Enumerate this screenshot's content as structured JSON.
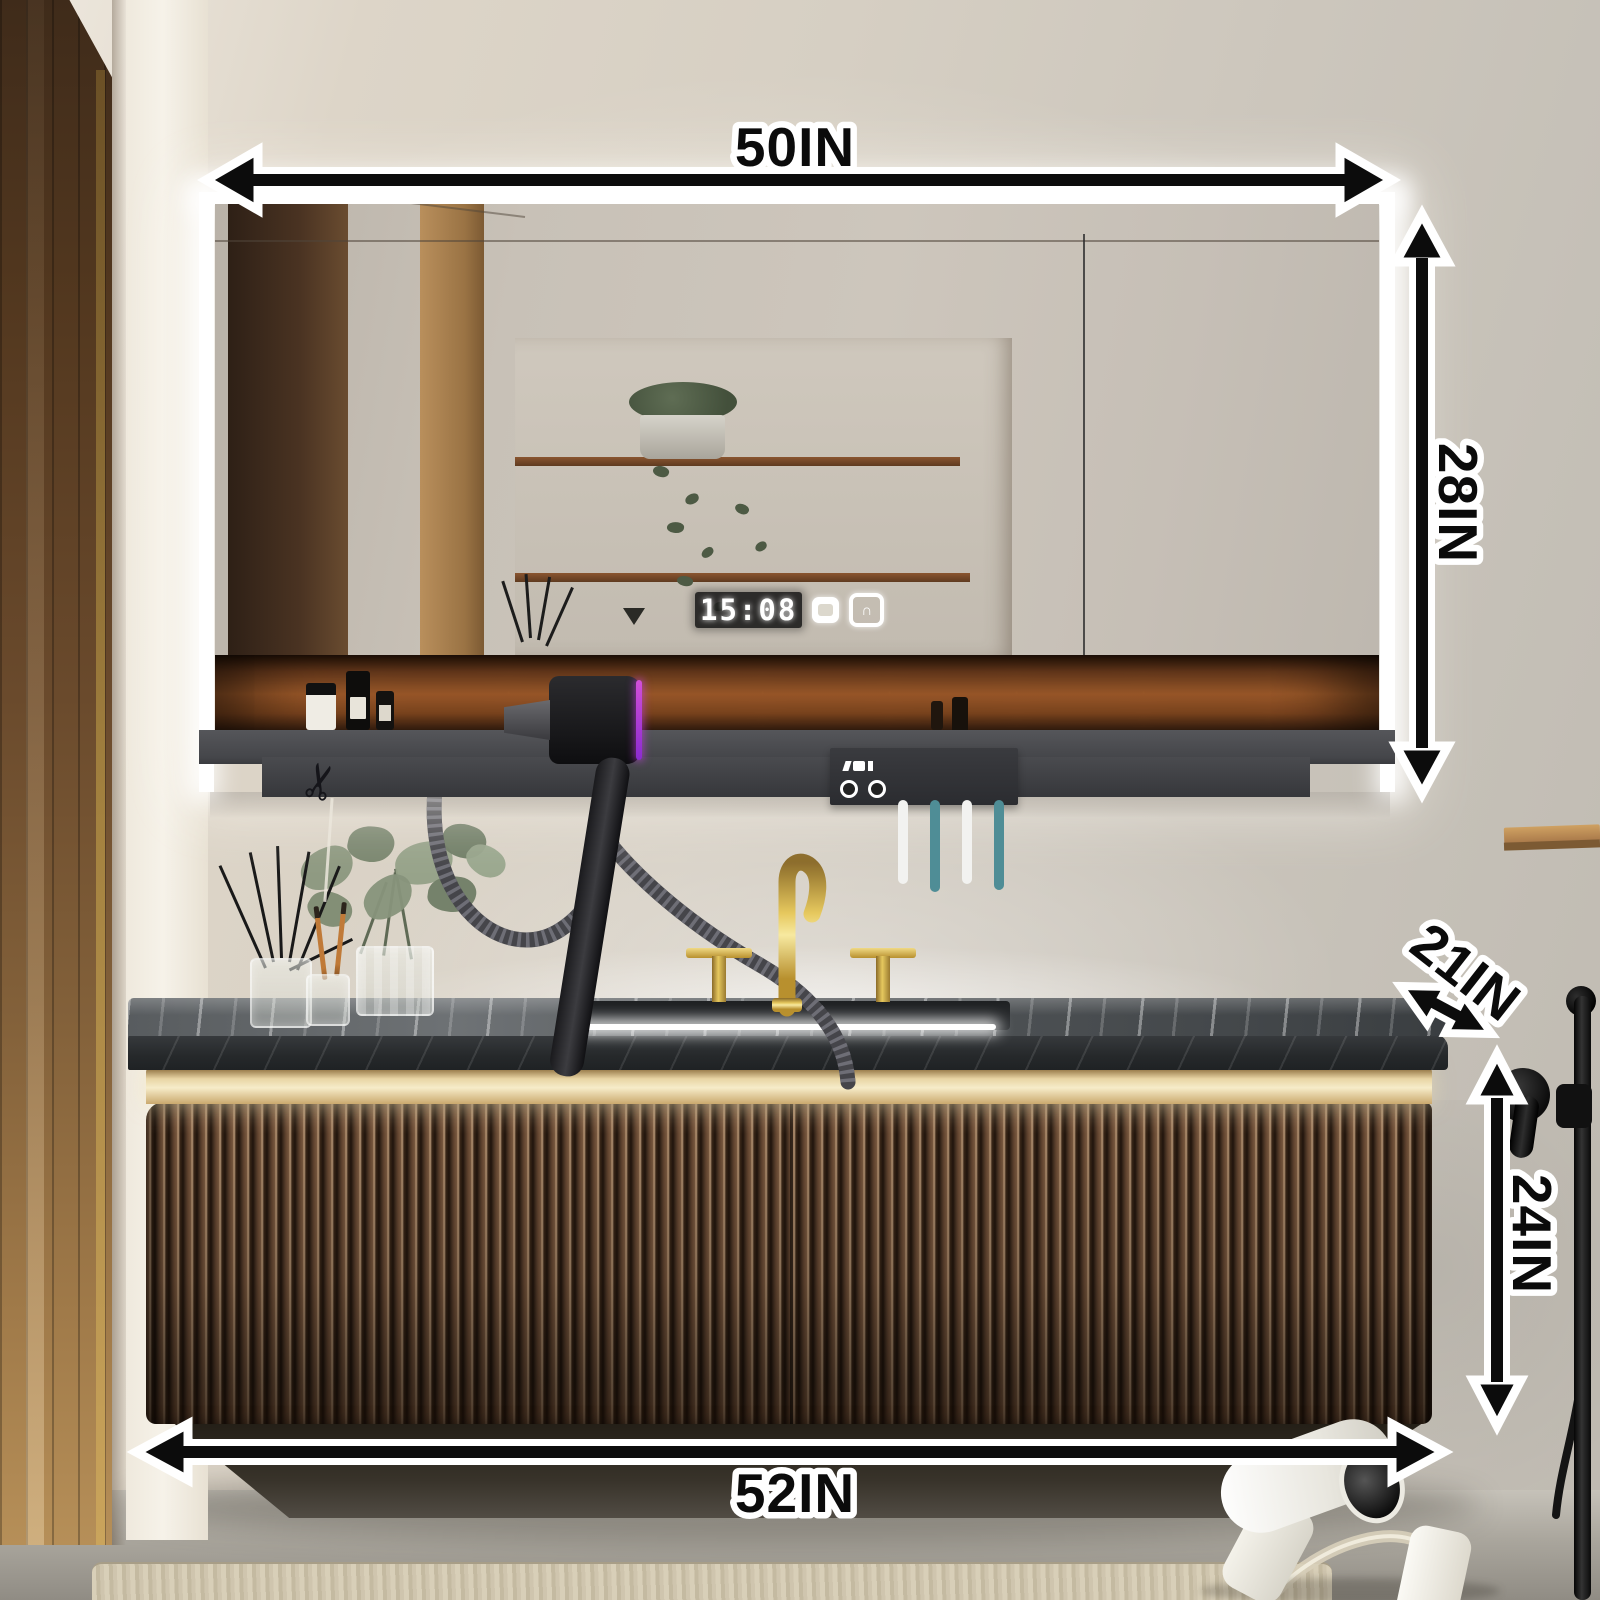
{
  "annotations": {
    "mirror_width": "50IN",
    "mirror_height": "28IN",
    "countertop_depth": "21IN",
    "vanity_height": "24IN",
    "vanity_width": "52IN"
  },
  "mirror_display": {
    "time": "15:08",
    "icons": [
      {
        "name": "defogger-icon"
      },
      {
        "name": "power-icon",
        "glyph": "∩"
      }
    ]
  },
  "icons": {
    "scissors_glyph": "✂"
  },
  "colors": {
    "annotation_fill": "#0b0b0b",
    "annotation_outline": "#ffffff",
    "wall_beige": "#d6cfc3",
    "led_white": "#ffffff",
    "wood_niche_glow": "#a65f2c",
    "shelf_gray": "#46474b",
    "vanity_walnut": "#4a3424",
    "gold_trim": "#e8d5a4",
    "faucet_gold": "#c9a227",
    "countertop_dark": "#2b2e30",
    "toothbrush_teal": "#4f8d96",
    "dryer_accent_purple": "#b04fd8"
  }
}
